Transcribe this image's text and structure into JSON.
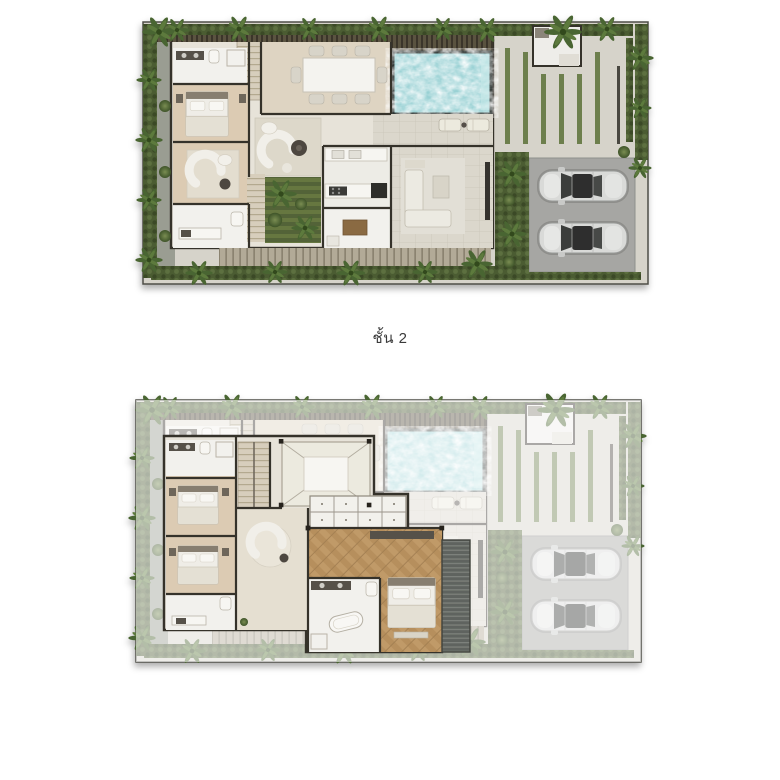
{
  "page": {
    "background": "#ffffff"
  },
  "plans": [
    {
      "name": "first-floor-site-plan",
      "caption": "",
      "features": [
        "swimming-pool",
        "sun-loungers",
        "dining-table",
        "kitchen",
        "living-room",
        "bedrooms",
        "bathrooms",
        "courtyard-garden",
        "timber-deck",
        "driveway",
        "two-parked-cars",
        "perimeter-hedge",
        "palm-trees"
      ]
    },
    {
      "name": "second-floor-plan",
      "caption": "ชั้น 2",
      "features": [
        "stair-hall",
        "double-height-void",
        "walk-in-closet",
        "master-bedroom",
        "master-bathroom",
        "two-bedrooms",
        "two-bathrooms",
        "louver-screen",
        "faded-ground-level"
      ]
    }
  ],
  "colors": {
    "wall": "#35312b",
    "floor": "#e7e3d9",
    "wood": "#dccbb3",
    "white": "#f2f1ed",
    "stone": "#dbd7cc",
    "paving": "#d6d3ca",
    "parking": "#a6a6a3",
    "hedge": "#4c5c33",
    "hedgeDark": "#3b4a27",
    "grass": "#6d7f4e",
    "pool": "#99d1d4",
    "poolRim": "#2e3532",
    "deck": "#b2aa97",
    "herr": "#c09a68",
    "louver": "#5f635e",
    "car": "#d9dad8",
    "captionColor": "#3a3a3a"
  }
}
